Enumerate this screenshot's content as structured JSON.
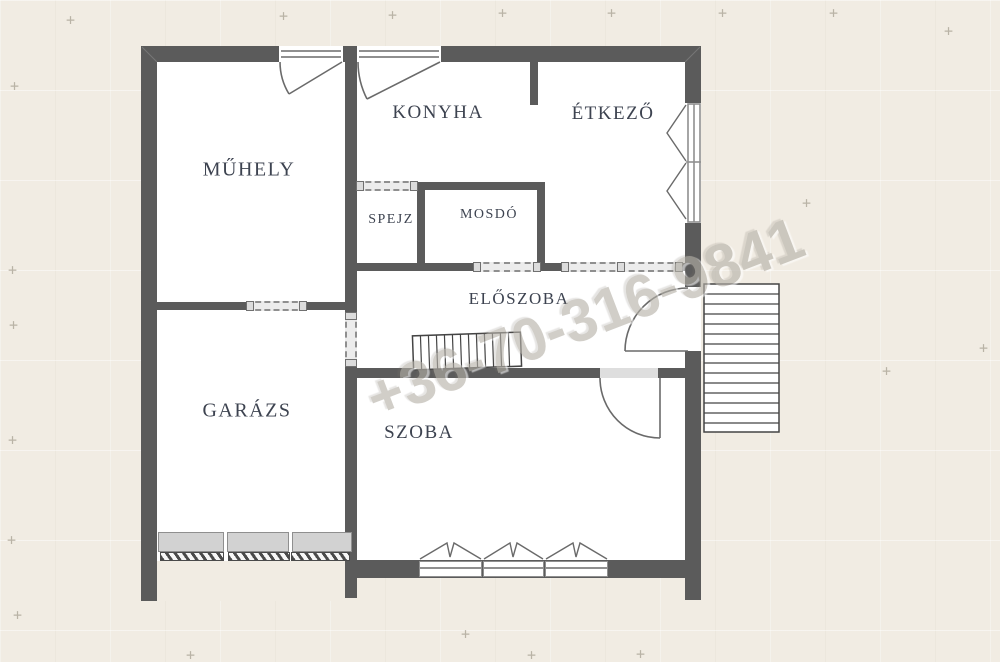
{
  "plan": {
    "title": "floor-plan",
    "watermark": "+36-70-316-9841",
    "rooms": {
      "muhely": "MŰHELY",
      "konyha": "KONYHA",
      "etkezo": "ÉTKEZŐ",
      "spejz": "SPEJZ",
      "mosdo": "MOSDÓ",
      "eloszoba": "ELŐSZOBA",
      "garazs": "GARÁZS",
      "szoba": "SZOBA"
    },
    "features": {
      "interior_stair": "stair-run-in-hallway",
      "exterior_stair": "stair-run-outside-right-wall",
      "garage_door": "sectional-garage-door-with-hatched-sill",
      "sliding_doors": 5,
      "swing_doors": 4,
      "windows": 5
    },
    "colors": {
      "background": "#f1ece3",
      "wall": "#5b5b5b",
      "floor": "#ffffff",
      "label": "#3d4350",
      "watermark": "#b5b1a8"
    }
  }
}
